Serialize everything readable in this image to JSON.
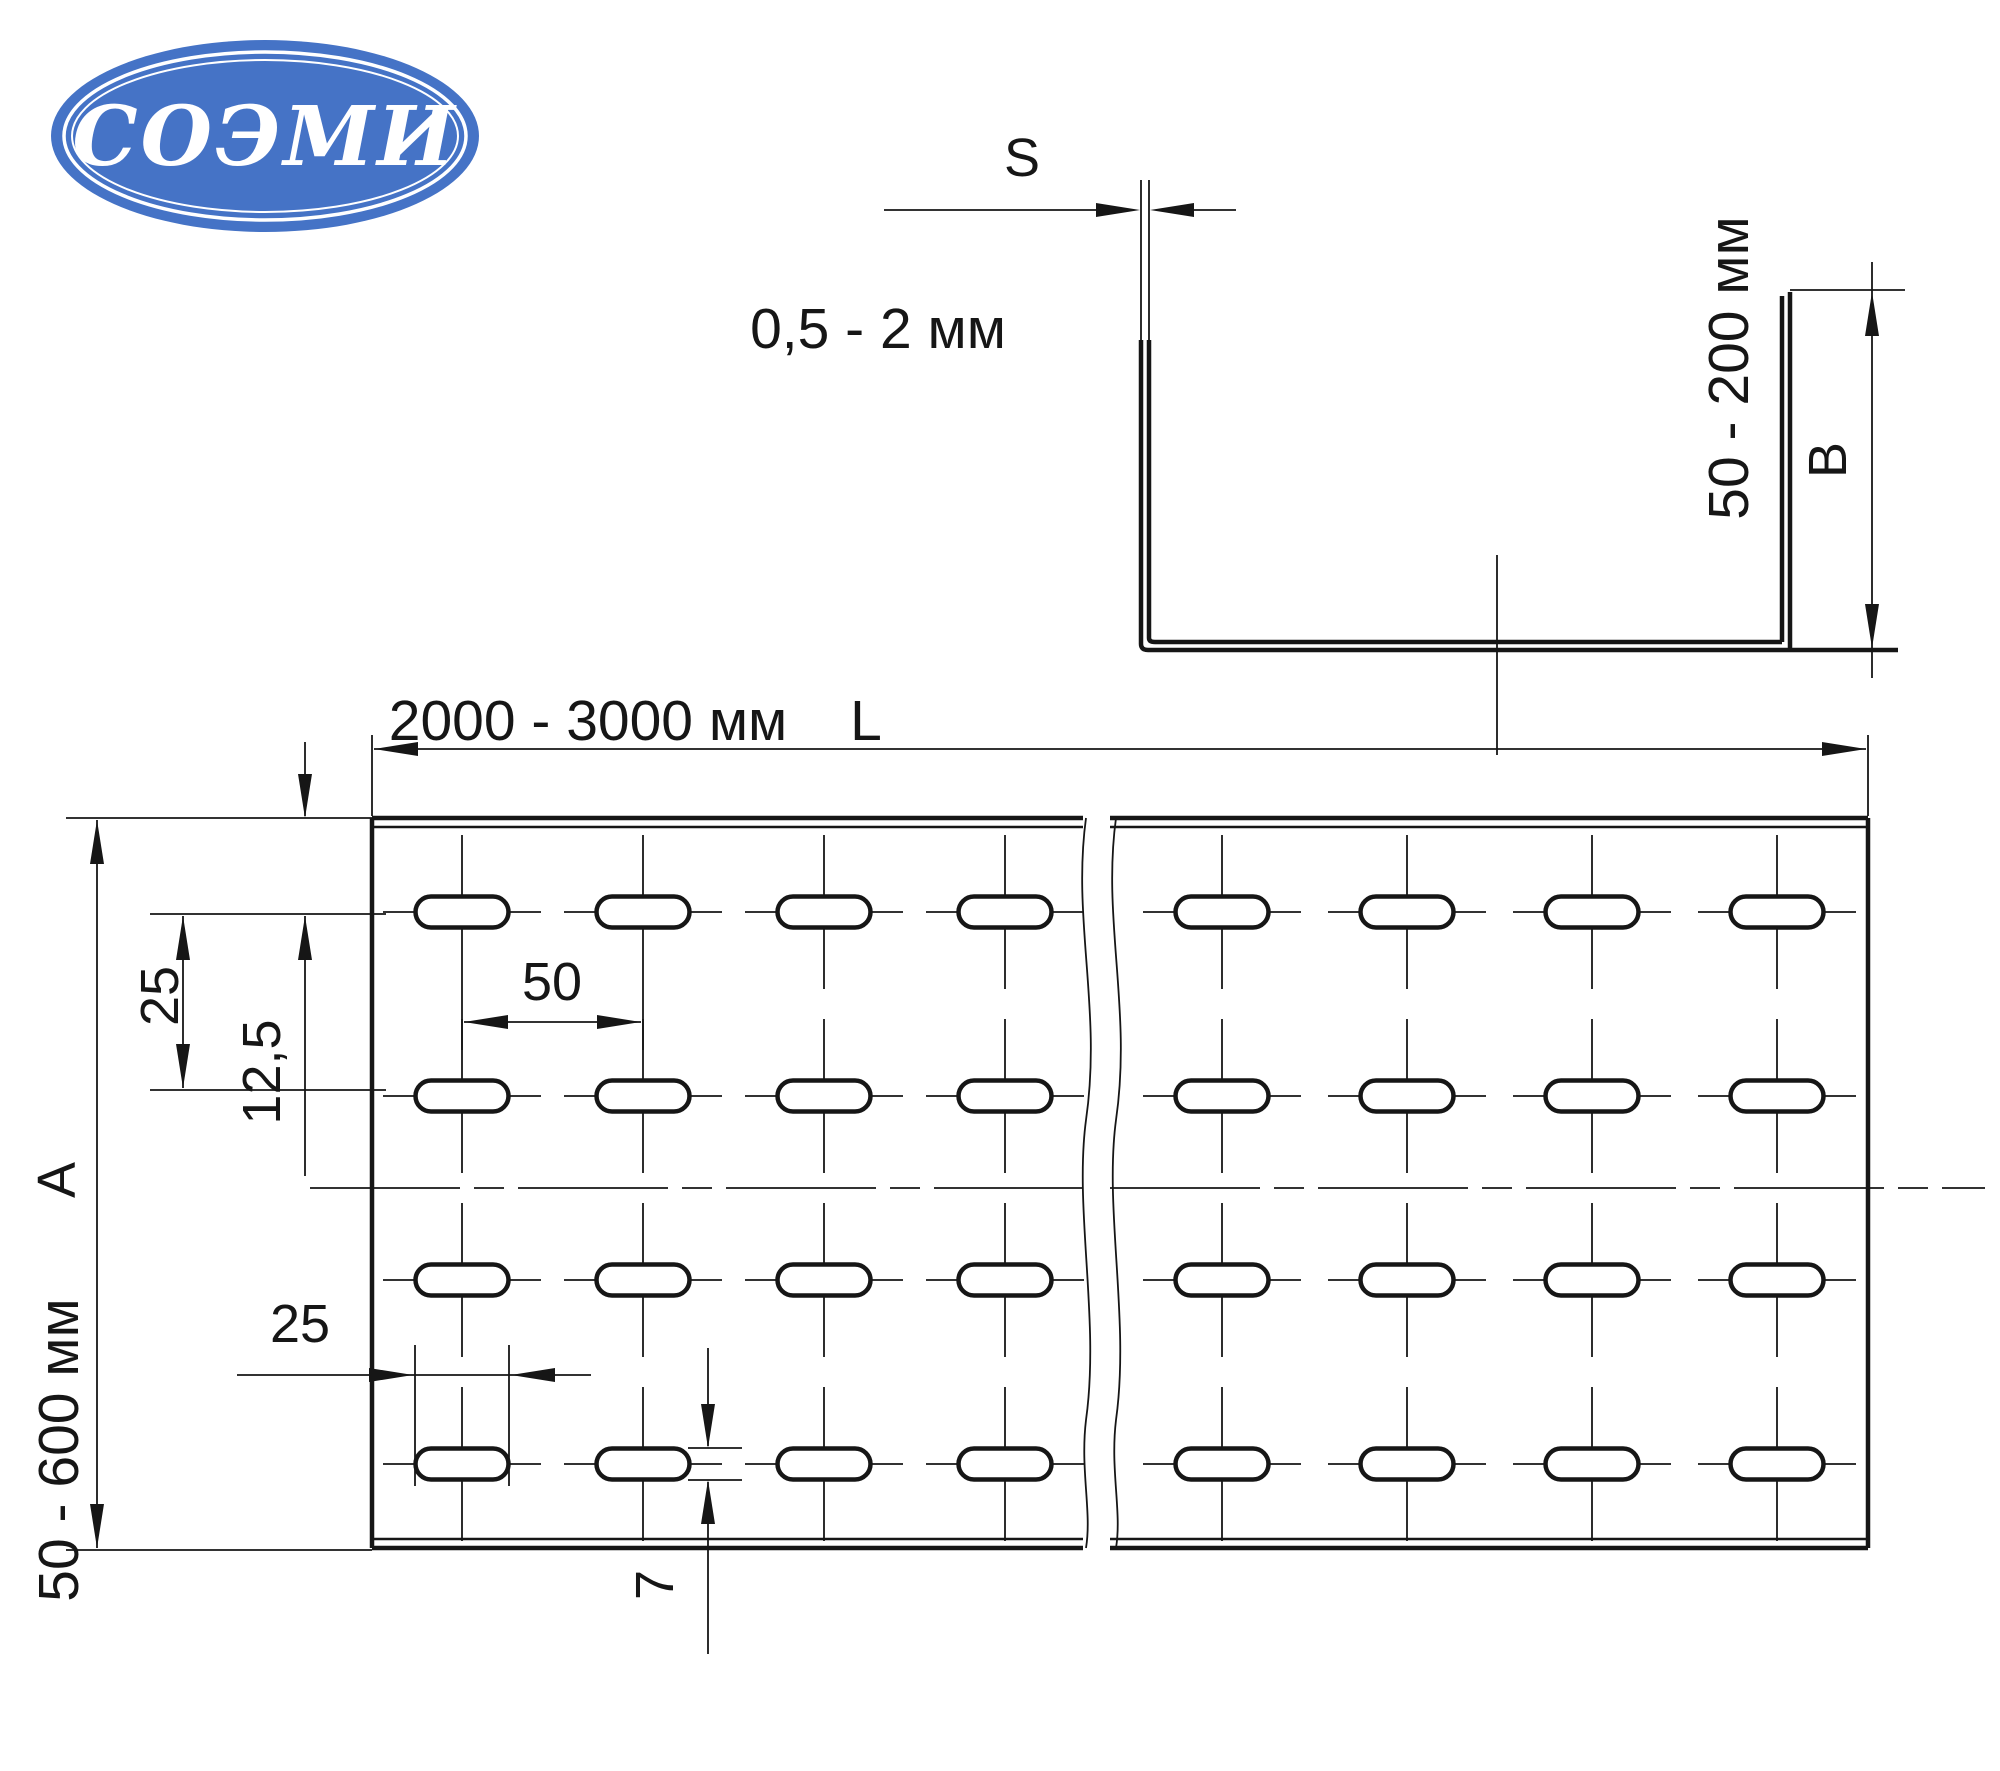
{
  "logo": {
    "text": "СОЭМИ",
    "bg_color": "#4573c6",
    "text_color": "#ffffff"
  },
  "cross_section": {
    "thickness_label": "S",
    "thickness_range": "0,5 - 2 мм",
    "height_range": "50 - 200 мм",
    "height_label": "B"
  },
  "plan_view": {
    "length_range": "2000 - 3000 мм",
    "length_label": "L",
    "edge_offset": "12,5",
    "row_spacing": "25",
    "hole_pitch": "50",
    "width_label": "A",
    "width_range": "50 - 600 мм",
    "slot_length": "25",
    "slot_width": "7",
    "grid": {
      "rows": 4,
      "cols_left": 4,
      "cols_right": 4
    }
  }
}
